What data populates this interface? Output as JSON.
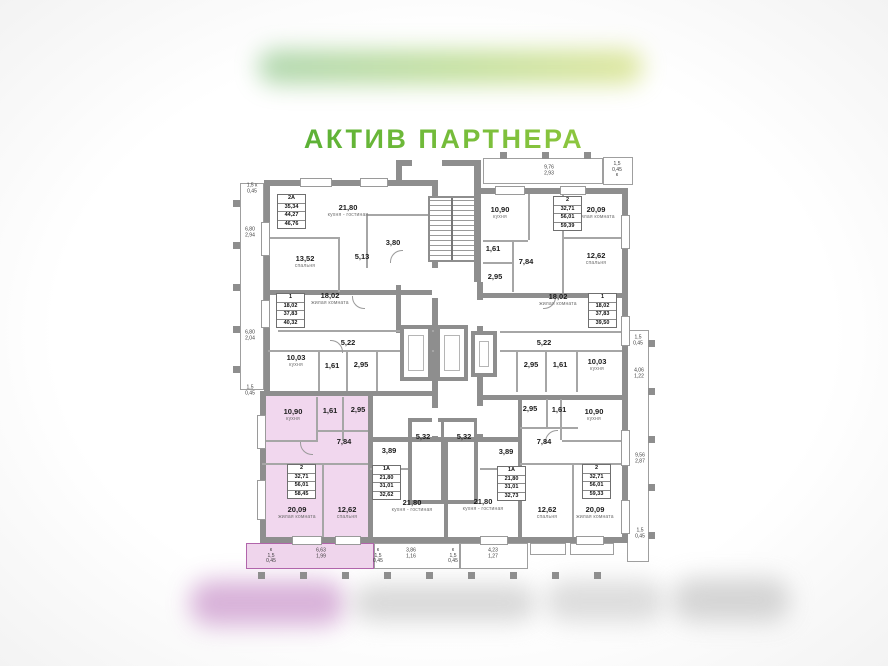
{
  "title": "АКТИВ ПАРТНЕРА",
  "colors": {
    "brand_green_start": "#2f9e44",
    "brand_green_end": "#bcd42f",
    "highlight_pink_fill": "#f1d7ee",
    "highlight_pink_border": "#b165ab",
    "wall_gray": "#8e8e8e"
  },
  "apartments": [
    {
      "name": "2А",
      "areas": [
        "35,34",
        "44,27",
        "46,76"
      ]
    },
    {
      "name": "1",
      "areas": [
        "18,02",
        "37,83",
        "40,32"
      ]
    },
    {
      "name": "2",
      "areas": [
        "32,71",
        "56,01",
        "58,45"
      ],
      "highlighted": true
    },
    {
      "name": "1А",
      "areas": [
        "21,80",
        "31,01",
        "32,62"
      ]
    },
    {
      "name": "1А",
      "areas": [
        "21,80",
        "31,01",
        "32,73"
      ]
    },
    {
      "name": "2",
      "areas": [
        "32,71",
        "56,01",
        "59,33"
      ]
    },
    {
      "name": "2",
      "areas": [
        "32,71",
        "56,01",
        "59,39"
      ]
    },
    {
      "name": "1",
      "areas": [
        "18,02",
        "37,83",
        "39,50"
      ]
    }
  ],
  "rooms": [
    {
      "area": "21,80",
      "label": "кухня - гостиная"
    },
    {
      "area": "13,52",
      "label": "спальня"
    },
    {
      "area": "5,13",
      "label": ""
    },
    {
      "area": "3,80",
      "label": ""
    },
    {
      "area": "18,02",
      "label": "жилая комната"
    },
    {
      "area": "5,22",
      "label": ""
    },
    {
      "area": "10,03",
      "label": "кухня"
    },
    {
      "area": "1,61",
      "label": ""
    },
    {
      "area": "2,95",
      "label": ""
    },
    {
      "area": "10,90",
      "label": "кухня"
    },
    {
      "area": "1,61",
      "label": ""
    },
    {
      "area": "2,95",
      "label": ""
    },
    {
      "area": "7,84",
      "label": ""
    },
    {
      "area": "20,09",
      "label": "жилая комната"
    },
    {
      "area": "12,62",
      "label": "спальня"
    },
    {
      "area": "3,89",
      "label": ""
    },
    {
      "area": "5,32",
      "label": ""
    },
    {
      "area": "21,80",
      "label": "кухня - гостиная"
    },
    {
      "area": "5,32",
      "label": ""
    },
    {
      "area": "3,89",
      "label": ""
    },
    {
      "area": "21,80",
      "label": "кухня - гостиная"
    },
    {
      "area": "2,95",
      "label": ""
    },
    {
      "area": "1,61",
      "label": ""
    },
    {
      "area": "10,90",
      "label": "кухня"
    },
    {
      "area": "7,84",
      "label": ""
    },
    {
      "area": "12,62",
      "label": "спальня"
    },
    {
      "area": "20,09",
      "label": "жилая комната"
    },
    {
      "area": "10,90",
      "label": "кухня"
    },
    {
      "area": "20,09",
      "label": "жилая комната"
    },
    {
      "area": "1,61",
      "label": ""
    },
    {
      "area": "7,84",
      "label": ""
    },
    {
      "area": "2,95",
      "label": ""
    },
    {
      "area": "12,62",
      "label": "спальня"
    },
    {
      "area": "18,02",
      "label": "жилая комната"
    },
    {
      "area": "5,22",
      "label": ""
    },
    {
      "area": "2,95",
      "label": ""
    },
    {
      "area": "1,61",
      "label": ""
    },
    {
      "area": "10,03",
      "label": "кухня"
    }
  ],
  "dims": [
    {
      "text": "1,5 к\n0,45"
    },
    {
      "text": "6,80\n2,94"
    },
    {
      "text": "6,80\n2,04"
    },
    {
      "text": "1,5\n0,45"
    },
    {
      "text": "9,76\n2,93"
    },
    {
      "text": "1,5\n0,45\nк"
    },
    {
      "text": "1,5\n0,45"
    },
    {
      "text": "4,06\n1,22"
    },
    {
      "text": "9,56\n2,87"
    },
    {
      "text": "1,5\n0,45"
    },
    {
      "text": "к\n1,5\n0,45"
    },
    {
      "text": "6,63\n1,99"
    },
    {
      "text": "к\n1,5\n0,45"
    },
    {
      "text": "3,86\n1,16"
    },
    {
      "text": "к\n1,5\n0,45"
    },
    {
      "text": "4,23\n1,27"
    }
  ]
}
